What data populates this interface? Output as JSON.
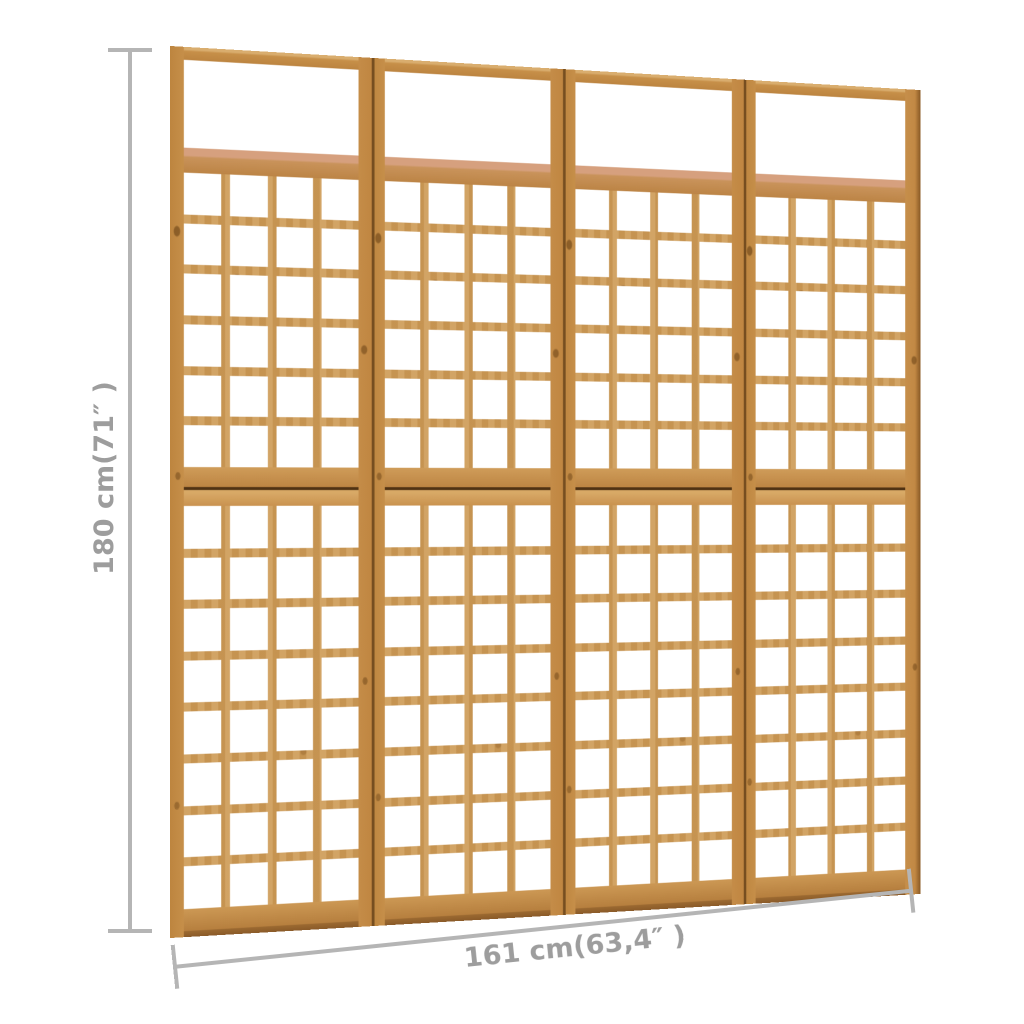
{
  "dimensions": {
    "height_label": "180 cm(71″ )",
    "width_label": "161 cm(63,4″ )"
  },
  "product": {
    "name": "4-panel wooden trellis room divider",
    "panel_count": 4,
    "upper_lattice": {
      "rows": 6,
      "cols": 4
    },
    "lower_lattice": {
      "rows": 8,
      "cols": 4
    }
  },
  "colors": {
    "wood_main": "#c8924e",
    "wood_light": "#d3a261",
    "wood_dark": "#b67f3e",
    "wood_salmon_edge": "#d6a07e",
    "section_seam": "#503213",
    "dimension_line": "#b5b5b5",
    "dimension_text": "#9d9d9d",
    "background": "#ffffff"
  }
}
